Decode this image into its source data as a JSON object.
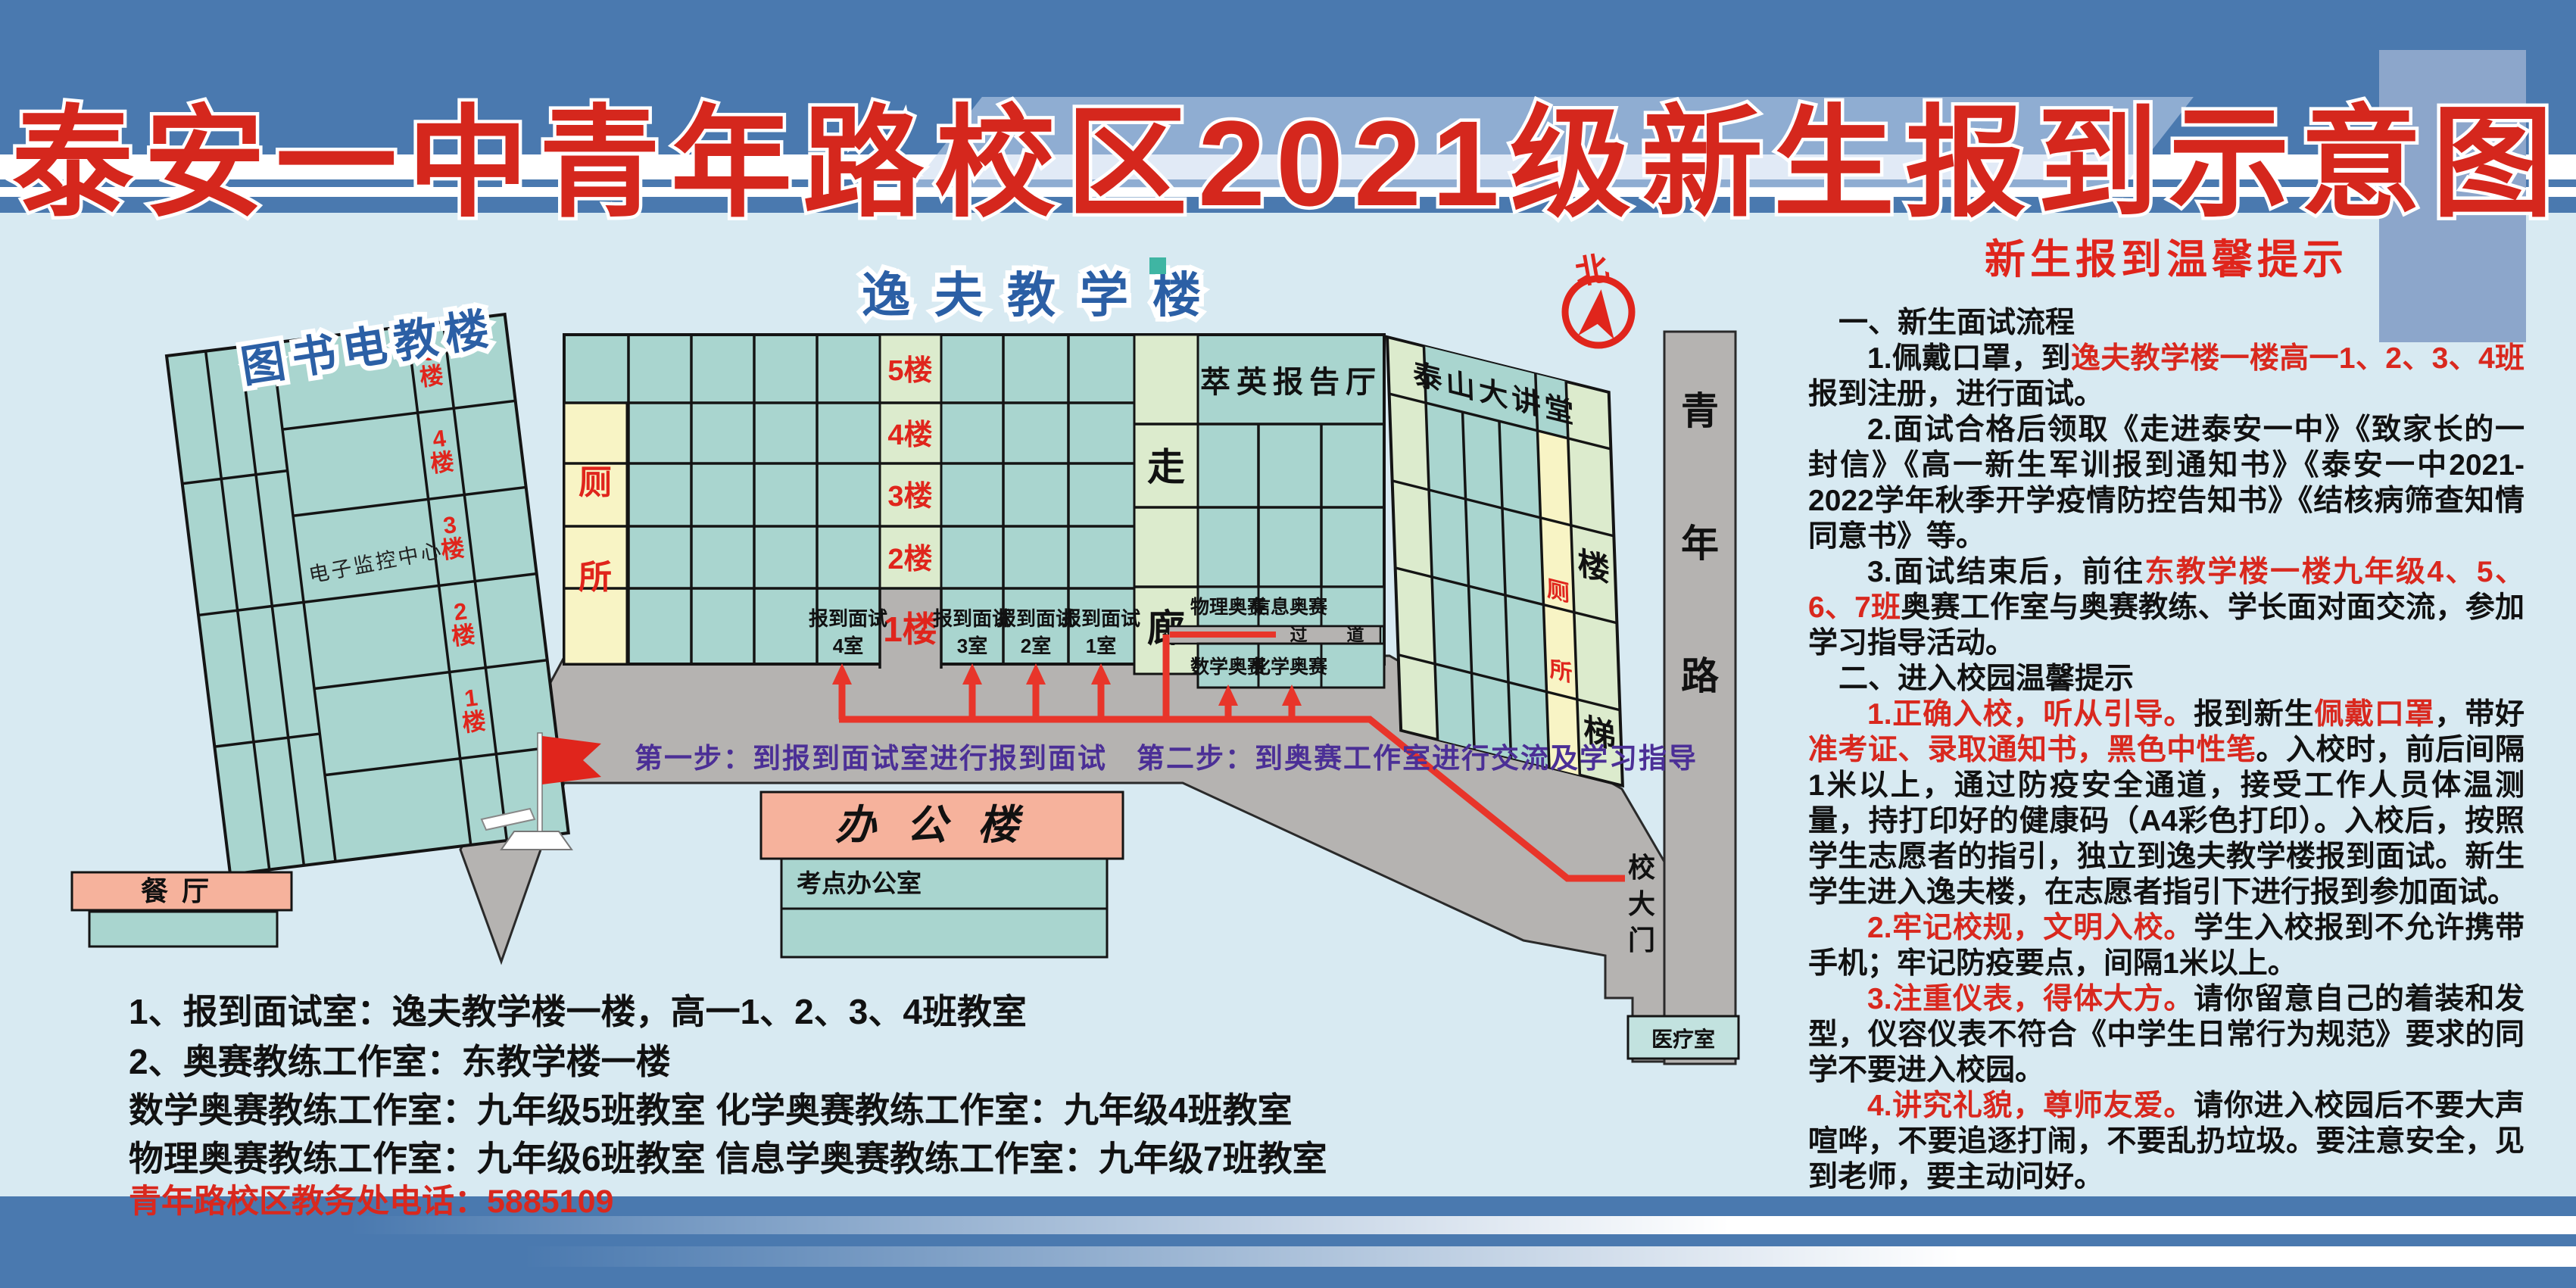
{
  "title": "泰安一中青年路校区2021级新生报到示意图",
  "map": {
    "north_label": "北",
    "library": {
      "name": "图书电教楼",
      "monitor_center": "电子监控中心",
      "floors": [
        {
          "n": "5",
          "f": "楼"
        },
        {
          "n": "4",
          "f": "楼"
        },
        {
          "n": "3",
          "f": "楼"
        },
        {
          "n": "2",
          "f": "楼"
        },
        {
          "n": "1",
          "f": "楼"
        }
      ]
    },
    "canteen": "餐厅",
    "yifu": {
      "name": "逸夫教学楼",
      "toilet": [
        "厕",
        "所"
      ],
      "floors": [
        "5楼",
        "4楼",
        "3楼",
        "2楼"
      ],
      "ground": "1楼",
      "corridor": [
        "走",
        "廊"
      ],
      "cuiying": "萃英报告厅",
      "rooms": [
        {
          "l1": "报到面试",
          "l2": "4室"
        },
        {
          "l1": "报到面试",
          "l2": "3室"
        },
        {
          "l1": "报到面试",
          "l2": "2室"
        },
        {
          "l1": "报到面试",
          "l2": "1室"
        }
      ],
      "olympiad_upper": [
        "物理奥赛",
        "信息奥赛"
      ],
      "passage": [
        "过",
        "道"
      ],
      "olympiad_lower": [
        "数学奥赛",
        "化学奥赛"
      ]
    },
    "east": {
      "name": "泰山大讲堂",
      "toilet": [
        "厕",
        "所"
      ],
      "stairs": [
        "楼",
        "梯"
      ]
    },
    "office": {
      "name": "办公楼",
      "room": "考点办公室"
    },
    "road": {
      "name": [
        "青",
        "年",
        "路"
      ],
      "gate": [
        "校",
        "大",
        "门"
      ]
    },
    "medical": "医疗室",
    "steps": "第一步：到报到面试室进行报到面试　第二步：到奥赛工作室进行交流及学习指导"
  },
  "legend": {
    "line1": "1、报到面试室：逸夫教学楼一楼，高一1、2、3、4班教室",
    "line2": "2、奥赛教练工作室：东教学楼一楼",
    "line3a": "数学奥赛教练工作室：九年级5班教室",
    "line3b": "化学奥赛教练工作室：九年级4班教室",
    "line4a": "物理奥赛教练工作室：九年级6班教室",
    "line4b": "信息学奥赛教练工作室：九年级7班教室",
    "phone": "青年路校区教务处电话：5885109"
  },
  "tips": {
    "title": "新生报到温馨提示",
    "paragraphs": [
      {
        "style": "header",
        "segments": [
          {
            "t": "一、新生面试流程"
          }
        ]
      },
      {
        "style": "body",
        "segments": [
          {
            "t": "1.佩戴口罩，到"
          },
          {
            "t": "逸夫教学楼一楼高一1、2、3、4班",
            "c": "red"
          },
          {
            "t": "报到注册，进行面试。"
          }
        ]
      },
      {
        "style": "body",
        "segments": [
          {
            "t": "2.面试合格后领取《走进泰安一中》《致家长的一封信》《高一新生军训报到通知书》《泰安一中2021-2022学年秋季开学疫情防控告知书》《结核病筛查知情同意书》等。"
          }
        ]
      },
      {
        "style": "body",
        "segments": [
          {
            "t": "3.面试结束后，前往"
          },
          {
            "t": "东教学楼一楼九年级4、5、6、7班",
            "c": "red"
          },
          {
            "t": "奥赛工作室与奥赛教练、学长面对面交流，参加学习指导活动。"
          }
        ]
      },
      {
        "style": "header",
        "segments": [
          {
            "t": "二、进入校园温馨提示"
          }
        ]
      },
      {
        "style": "body",
        "segments": [
          {
            "t": "1.正确入校，听从引导。",
            "c": "red"
          },
          {
            "t": "报到新生"
          },
          {
            "t": "佩戴口罩",
            "c": "red"
          },
          {
            "t": "，带好"
          },
          {
            "t": "准考证、录取通知书，黑色中性笔",
            "c": "red"
          },
          {
            "t": "。入校时，前后间隔1米以上，通过防疫安全通道，接受工作人员体温测量，持打印好的健康码（A4彩色打印）。入校后，按照学生志愿者的指引，独立到逸夫教学楼报到面试。新生学生进入逸夫楼，在志愿者指引下进行报到参加面试。"
          }
        ]
      },
      {
        "style": "body",
        "segments": [
          {
            "t": "2.牢记校规，文明入校。",
            "c": "red"
          },
          {
            "t": "学生入校报到不允许携带手机；牢记防疫要点，间隔1米以上。"
          }
        ]
      },
      {
        "style": "body",
        "segments": [
          {
            "t": "3.注重仪表，得体大方。",
            "c": "red"
          },
          {
            "t": "请你留意自己的着装和发型，仪容仪表不符合《中学生日常行为规范》要求的同学不要进入校园。"
          }
        ]
      },
      {
        "style": "body",
        "segments": [
          {
            "t": "4.讲究礼貌，尊师友爱。",
            "c": "red"
          },
          {
            "t": "请你进入校园后不要大声喧哗，不要追逐打闹，不要乱扔垃圾。要注意安全，见到老师，要主动问好。"
          }
        ]
      }
    ]
  },
  "colors": {
    "header_blue": "#4a79af",
    "title_red": "#d5271d",
    "building_teal": "#a9d5cf",
    "pale_green": "#dcebcd",
    "pale_yellow": "#f8f4c5",
    "road_gray": "#b5b3b1",
    "path_red": "#e8352a",
    "step_purple": "#4b2f96",
    "label_blue": "#2b5fa5",
    "office_pink": "#f6b29c"
  }
}
